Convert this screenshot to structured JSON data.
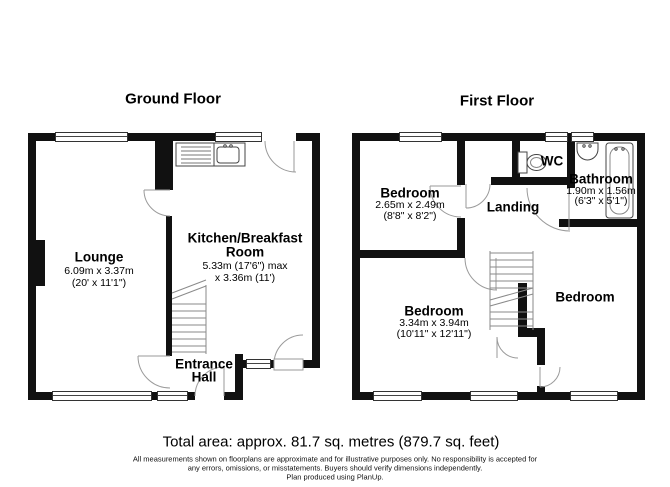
{
  "titles": {
    "ground": "Ground Floor",
    "first": "First Floor"
  },
  "ground": {
    "lounge": {
      "name": "Lounge",
      "metric": "6.09m x 3.37m",
      "imperial": "(20' x 11'1\")"
    },
    "kitchen": {
      "name_line1": "Kitchen/Breakfast",
      "name_line2": "Room",
      "metric": "5.33m (17'6\") max",
      "metric2": "x 3.36m (11')"
    },
    "hall": {
      "name_line1": "Entrance",
      "name_line2": "Hall"
    }
  },
  "first": {
    "bedroom_top": {
      "name": "Bedroom",
      "metric": "2.65m x 2.49m",
      "imperial": "(8'8\" x 8'2\")"
    },
    "wc": {
      "name": "WC"
    },
    "bathroom": {
      "name": "Bathroom",
      "metric": "1.90m x 1.56m",
      "imperial": "(6'3\" x 5'1\")"
    },
    "landing": {
      "name": "Landing"
    },
    "bedroom_left": {
      "name": "Bedroom",
      "metric": "3.34m x 3.94m",
      "imperial": "(10'11\" x 12'11\")"
    },
    "bedroom_right": {
      "name": "Bedroom"
    }
  },
  "footer": {
    "total_area": "Total area: approx. 81.7 sq. metres (879.7 sq. feet)",
    "disclaimer1": "All measurements shown on floorplans are approximate and for illustrative purposes only. No responsibility is accepted for",
    "disclaimer2": "any errors, omissions, or misstatements. Buyers should verify dimensions independently.",
    "disclaimer3": "Plan produced using PlanUp."
  },
  "colors": {
    "wall": "#111111",
    "door_line": "#9a9a9a",
    "fixture": "#444444"
  }
}
